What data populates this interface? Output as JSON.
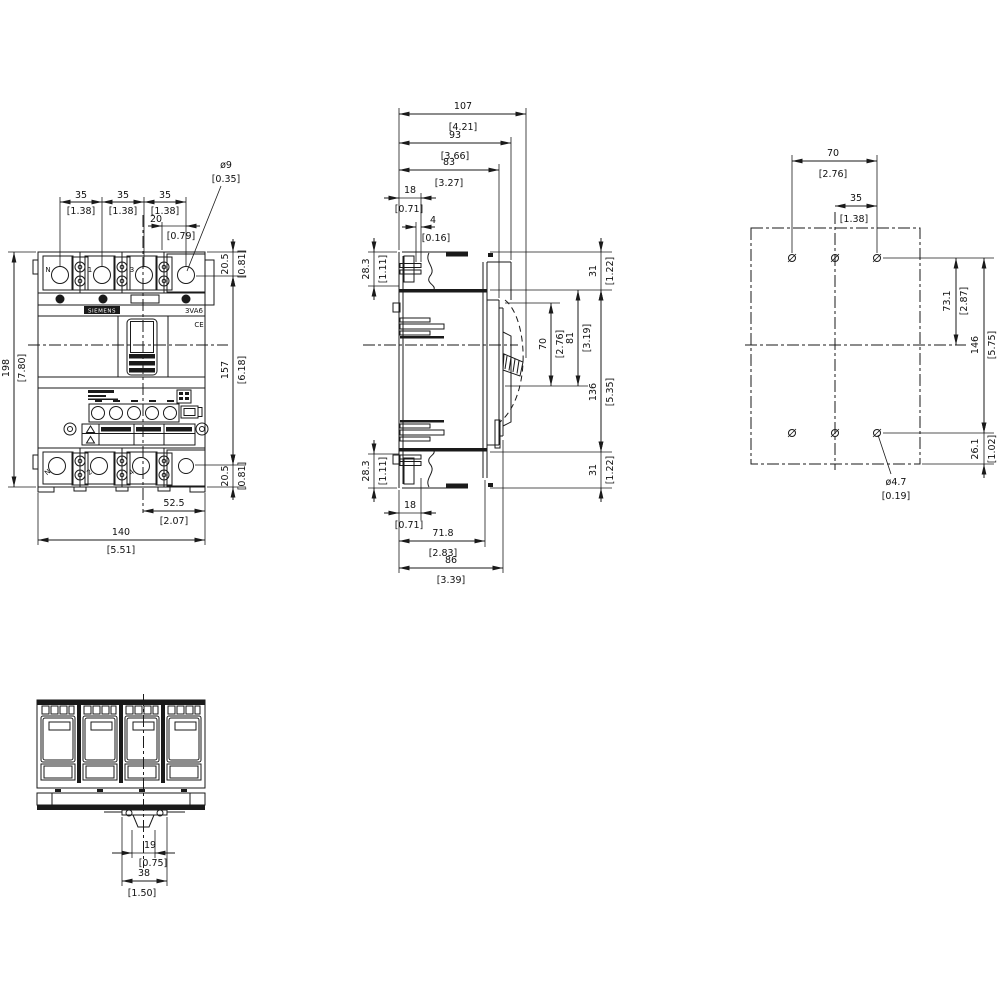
{
  "meta": {
    "brand": "SIEMENS",
    "product": "3VA6",
    "ce": "CE"
  },
  "front": {
    "top_terminals": [
      "N",
      "1",
      "3"
    ],
    "bottom_terminals": [
      "N",
      "2",
      "4"
    ],
    "dims": {
      "pitch1": {
        "mm": "35",
        "in": "[1.38]"
      },
      "pitch2": {
        "mm": "35",
        "in": "[1.38]"
      },
      "pitch3": {
        "mm": "35",
        "in": "[1.38]"
      },
      "fix_offset": {
        "mm": "20",
        "in": "[0.79]"
      },
      "fix_hole": {
        "mm": "ø9",
        "in": "[0.35]"
      },
      "top_edge": {
        "mm": "20.5",
        "in": "[0.81]"
      },
      "height": {
        "mm": "198",
        "in": "[7.80]"
      },
      "hole_span": {
        "mm": "157",
        "in": "[6.18]"
      },
      "bottom_edge": {
        "mm": "20.5",
        "in": "[0.81]"
      },
      "center_to_edge": {
        "mm": "52.5",
        "in": "[2.07]"
      },
      "width": {
        "mm": "140",
        "in": "[5.51]"
      }
    }
  },
  "side": {
    "dims": {
      "depth_max": {
        "mm": "107",
        "in": "[4.21]"
      },
      "depth_bezel": {
        "mm": "93",
        "in": "[3.66]"
      },
      "depth_cover": {
        "mm": "83",
        "in": "[3.27]"
      },
      "lug_depth_top": {
        "mm": "18",
        "in": "[0.71]"
      },
      "lug_thickness": {
        "mm": "4",
        "in": "[0.16]"
      },
      "terminal_top": {
        "mm": "28.3",
        "in": "[1.11]"
      },
      "edge_top": {
        "mm": "31",
        "in": "[1.22]"
      },
      "handle_a": {
        "mm": "70",
        "in": "[2.76]"
      },
      "handle_b": {
        "mm": "81",
        "in": "[3.19]"
      },
      "front_height": {
        "mm": "136",
        "in": "[5.35]"
      },
      "terminal_bottom": {
        "mm": "28.3",
        "in": "[1.11]"
      },
      "edge_bottom": {
        "mm": "31",
        "in": "[1.22]"
      },
      "lug_depth_bottom": {
        "mm": "18",
        "in": "[0.71]"
      },
      "depth_body": {
        "mm": "71.8",
        "in": "[2.83]"
      },
      "depth": {
        "mm": "86",
        "in": "[3.39]"
      }
    }
  },
  "drill": {
    "dims": {
      "span": {
        "mm": "70",
        "in": "[2.76]"
      },
      "half_span": {
        "mm": "35",
        "in": "[1.38]"
      },
      "upper": {
        "mm": "73.1",
        "in": "[2.87]"
      },
      "vspan": {
        "mm": "146",
        "in": "[5.75]"
      },
      "lower": {
        "mm": "26.1",
        "in": "[1.02]"
      },
      "hole": {
        "mm": "ø4.7",
        "in": "[0.19]"
      }
    }
  },
  "bottom": {
    "dims": {
      "clip_inner": {
        "mm": "19",
        "in": "[0.75]"
      },
      "clip_outer": {
        "mm": "38",
        "in": "[1.50]"
      }
    }
  }
}
